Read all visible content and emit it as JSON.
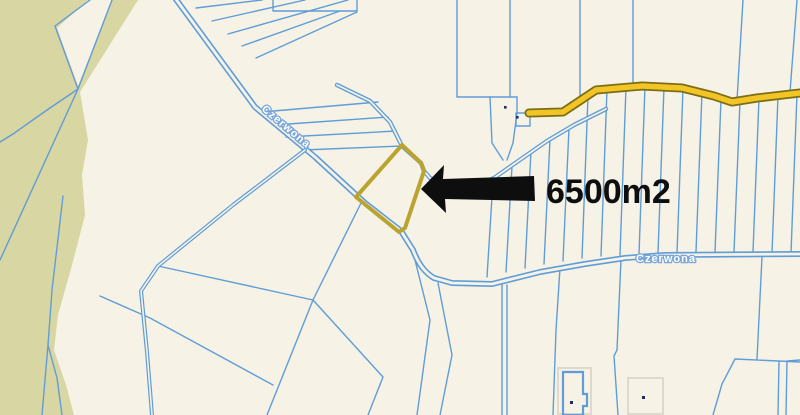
{
  "map": {
    "street_name": "Czerwona",
    "annotation": {
      "area_label": "6500m2",
      "arrow_icon": "left-block-arrow-icon"
    },
    "colors": {
      "background": "#f6f2e6",
      "forest": "#d8d6a2",
      "parcel_line": "#5f9dd8",
      "road_fill": "#f2c524",
      "road_casing": "#7c6d17",
      "highlight_parcel": "#bba32f",
      "annotation_ink": "#0e0e0e",
      "label_text": "#ffffff",
      "label_halo": "#7aa6d8",
      "point_marker": "#1c2e63",
      "faint_outline": "#d9d3c3"
    }
  }
}
